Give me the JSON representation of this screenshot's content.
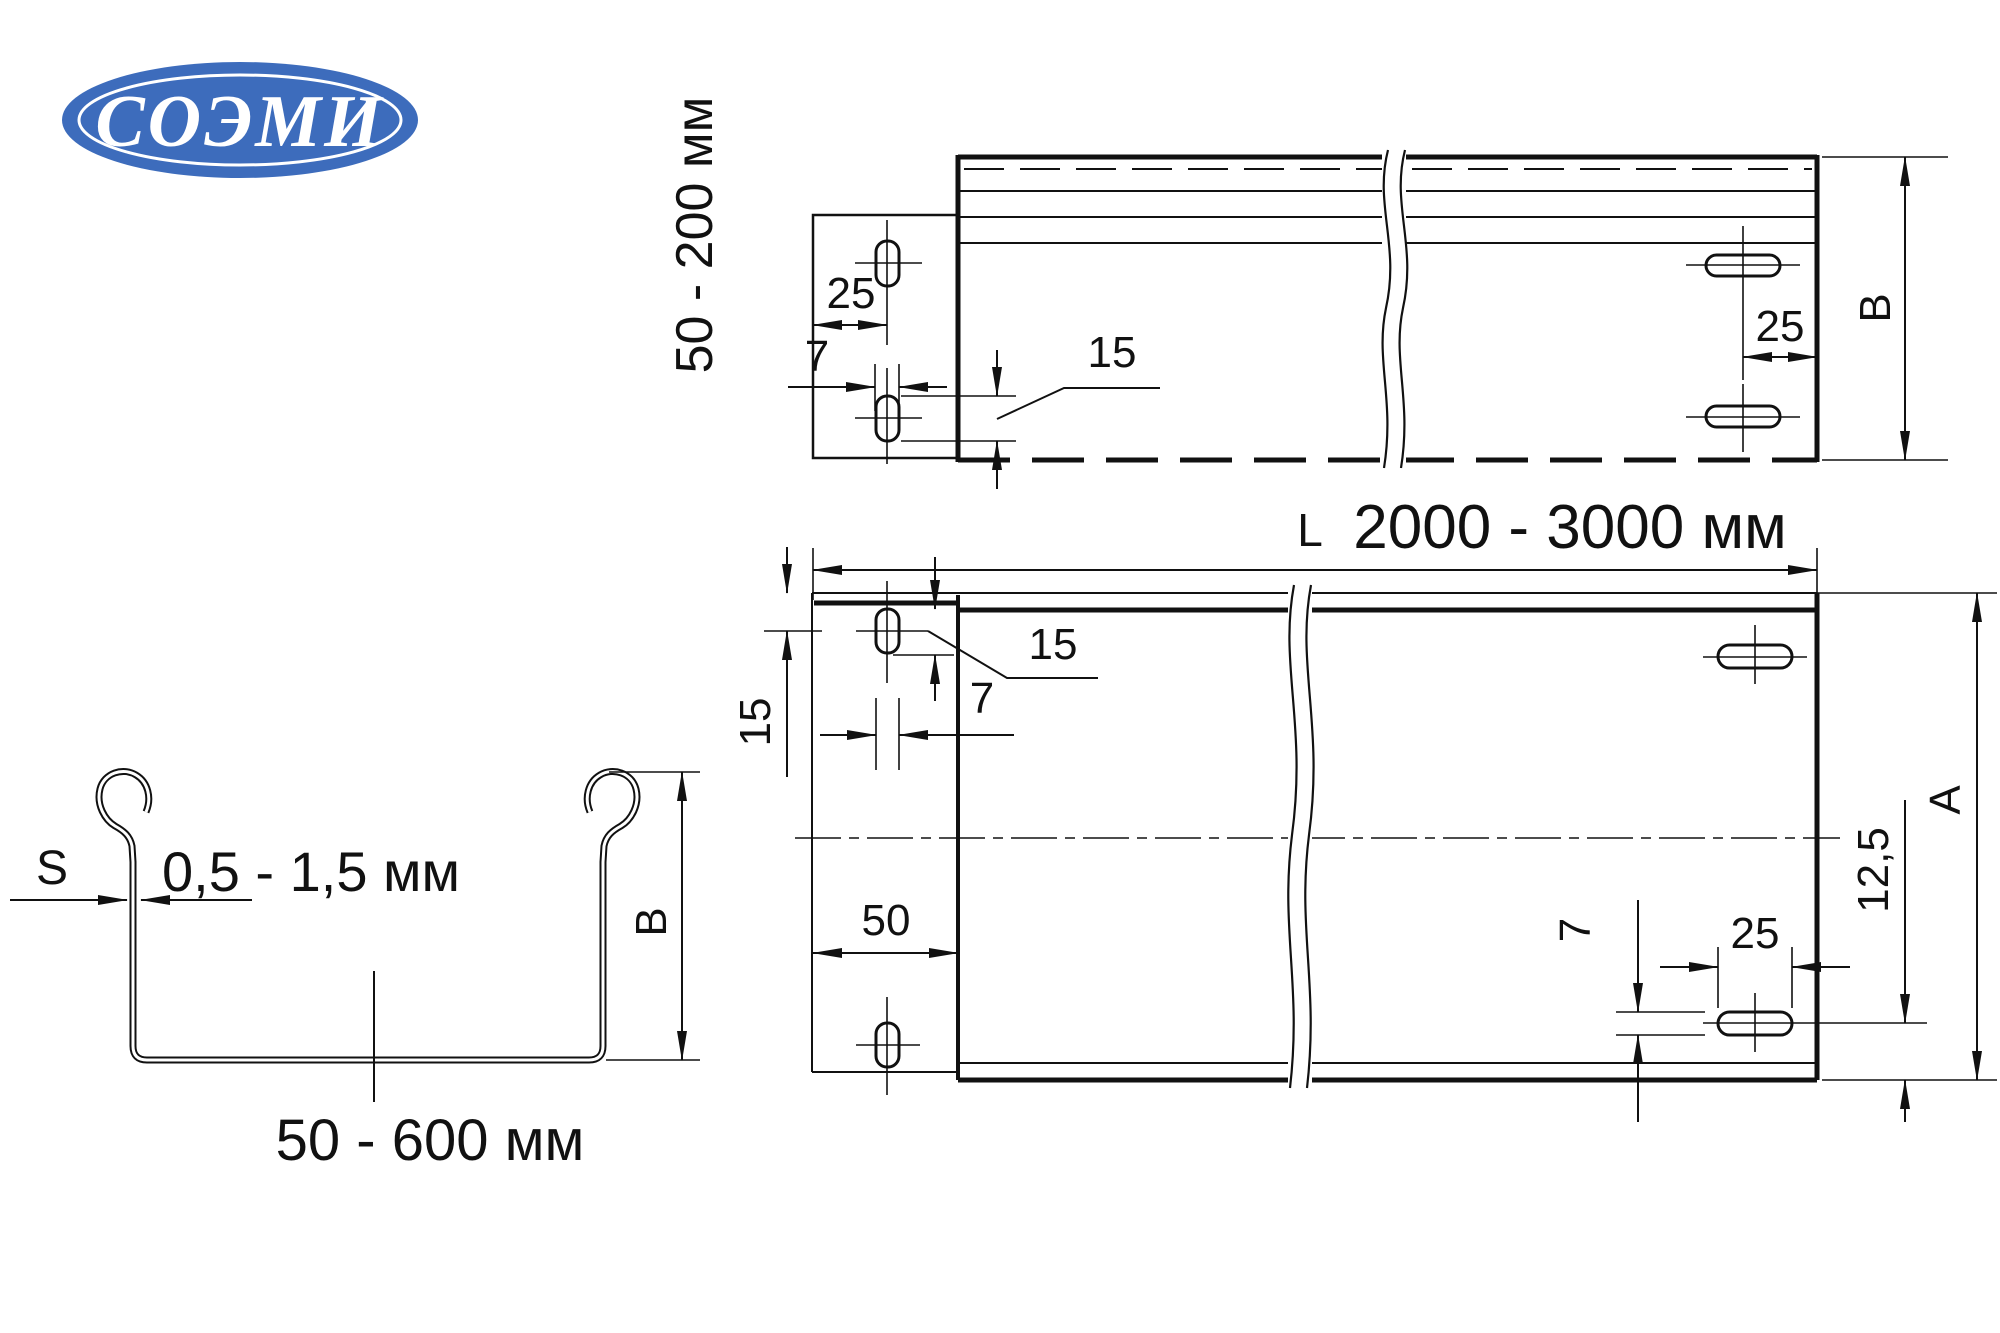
{
  "logo": {
    "text": "СОЭМИ",
    "bg_color": "#3d6cbc"
  },
  "side_view": {
    "range_label": "50 - 200 мм",
    "tab_offset": "25",
    "tab_slot_width": "7",
    "slot_length": "15",
    "right_offset": "25",
    "height_label": "B"
  },
  "plan_view": {
    "length_prefix": "L",
    "length_range": "2000 - 3000 мм",
    "edge_to_slot": "15",
    "slot_length": "15",
    "slot_width_top": "7",
    "tab_width": "50",
    "slot_width_bottom": "7",
    "slot_length_bottom": "25",
    "bottom_offset": "12,5",
    "width_label": "A"
  },
  "cross_section": {
    "thickness_symbol": "S",
    "thickness_range": "0,5 - 1,5 мм",
    "width_range": "50 - 600 мм",
    "height_label": "B"
  }
}
